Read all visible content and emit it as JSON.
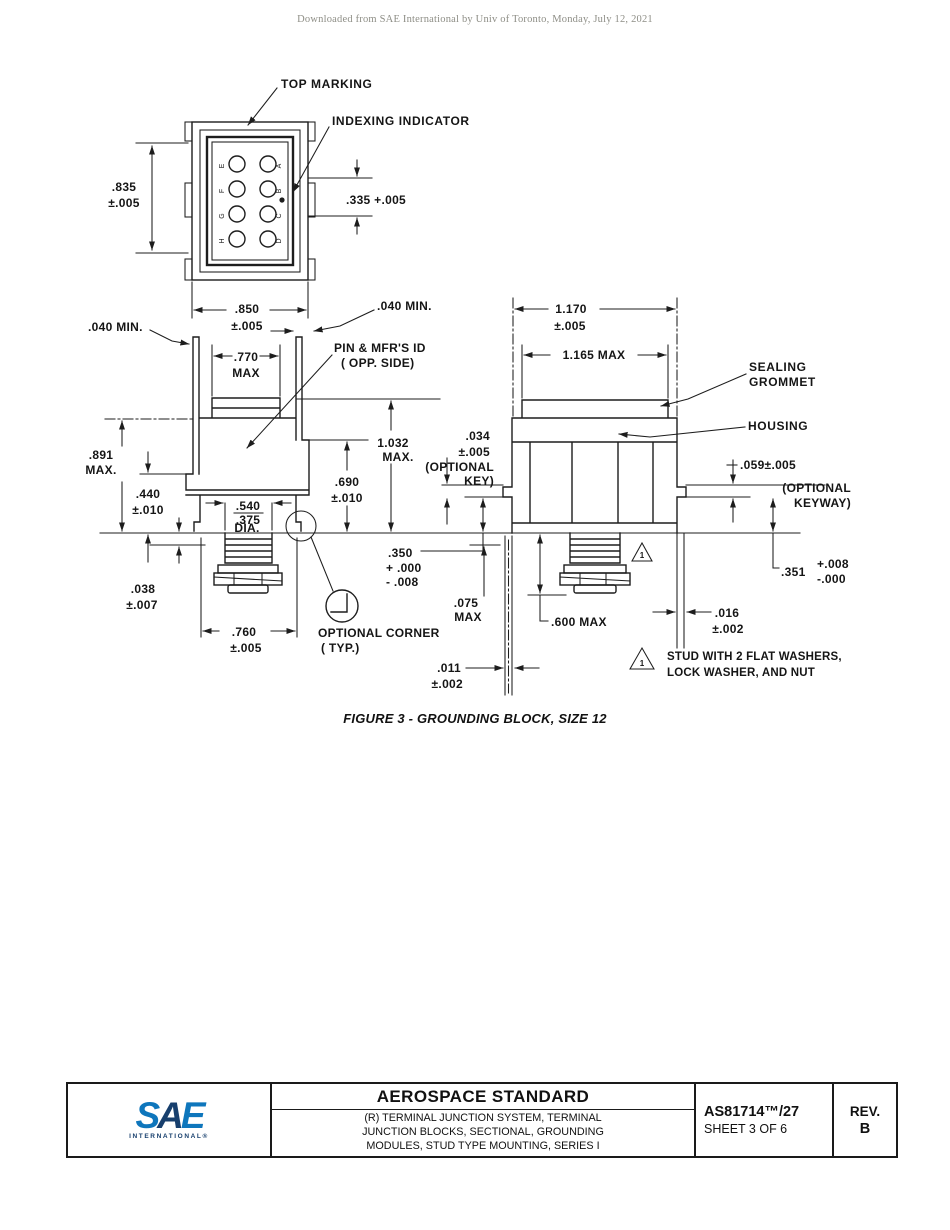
{
  "page": {
    "header_note": "Downloaded from SAE International by Univ of Toronto, Monday, July 12, 2021"
  },
  "figure_caption": "FIGURE 3 - GROUNDING BLOCK, SIZE 12",
  "drawing": {
    "labels": {
      "top_marking": "TOP MARKING",
      "indexing_indicator": "INDEXING INDICATOR",
      "pin_id_line1": "PIN & MFR'S ID",
      "pin_id_line2": "( OPP. SIDE)",
      "sealing_line1": "SEALING",
      "sealing_line2": "GROMMET",
      "housing": "HOUSING",
      "optional_corner_line1": "OPTIONAL CORNER",
      "optional_corner_line2": "( TYP.)",
      "flag_note_line1": "STUD WITH 2 FLAT WASHERS,",
      "flag_note_line2": "LOCK WASHER, AND NUT",
      "flag_number": "1"
    },
    "cavities": {
      "left": [
        "E",
        "F",
        "G",
        "H"
      ],
      "right": [
        "A",
        "B",
        "C",
        "D"
      ]
    },
    "dims": {
      "h835": ".835",
      "h835_tol": "±.005",
      "w335": ".335 +.005",
      "w850": ".850",
      "w850_tol": "±.005",
      "min040_left": ".040 MIN.",
      "min040_right": ".040 MIN.",
      "w770": ".770",
      "w770_max": "MAX",
      "h891": ".891",
      "h891_max": "MAX.",
      "h440": ".440",
      "h440_tol": "±.010",
      "d540": ".540",
      "d375": ".375",
      "dia": "DIA.",
      "h1032": "1.032",
      "h1032_max": "MAX.",
      "h690": ".690",
      "h690_tol": "±.010",
      "h038": ".038",
      "h038_tol": "±.007",
      "w760": ".760",
      "w760_tol": "±.005",
      "k350": ".350",
      "k350_plus": "+ .000",
      "k350_minus": "- .008",
      "w1170": "1.170",
      "w1170_tol": "±.005",
      "w1165": "1.165 MAX",
      "k034": ".034",
      "k034_tol": "±.005",
      "k034_note1": "(OPTIONAL",
      "k034_note2": "KEY)",
      "k059": ".059±.005",
      "k059_note1": "(OPTIONAL",
      "k059_note2": "KEYWAY)",
      "h075": ".075",
      "h075_max": "MAX",
      "h600": ".600 MAX",
      "k351": ".351",
      "k351_plus": "+.008",
      "k351_minus": "-.000",
      "w016": ".016",
      "w016_tol": "±.002",
      "w011": ".011",
      "w011_tol": "±.002"
    }
  },
  "footer": {
    "logo": {
      "s": "S",
      "a": "A",
      "e": "E",
      "subtext": "INTERNATIONAL®"
    },
    "title": "AEROSPACE STANDARD",
    "subtitle_line1": "(R) TERMINAL JUNCTION SYSTEM, TERMINAL",
    "subtitle_line2": "JUNCTION BLOCKS, SECTIONAL, GROUNDING",
    "subtitle_line3": "MODULES, STUD TYPE MOUNTING, SERIES I",
    "doc_number": "AS81714™/27",
    "sheet": "SHEET 3 OF 6",
    "rev_label": "REV.",
    "rev_value": "B"
  }
}
